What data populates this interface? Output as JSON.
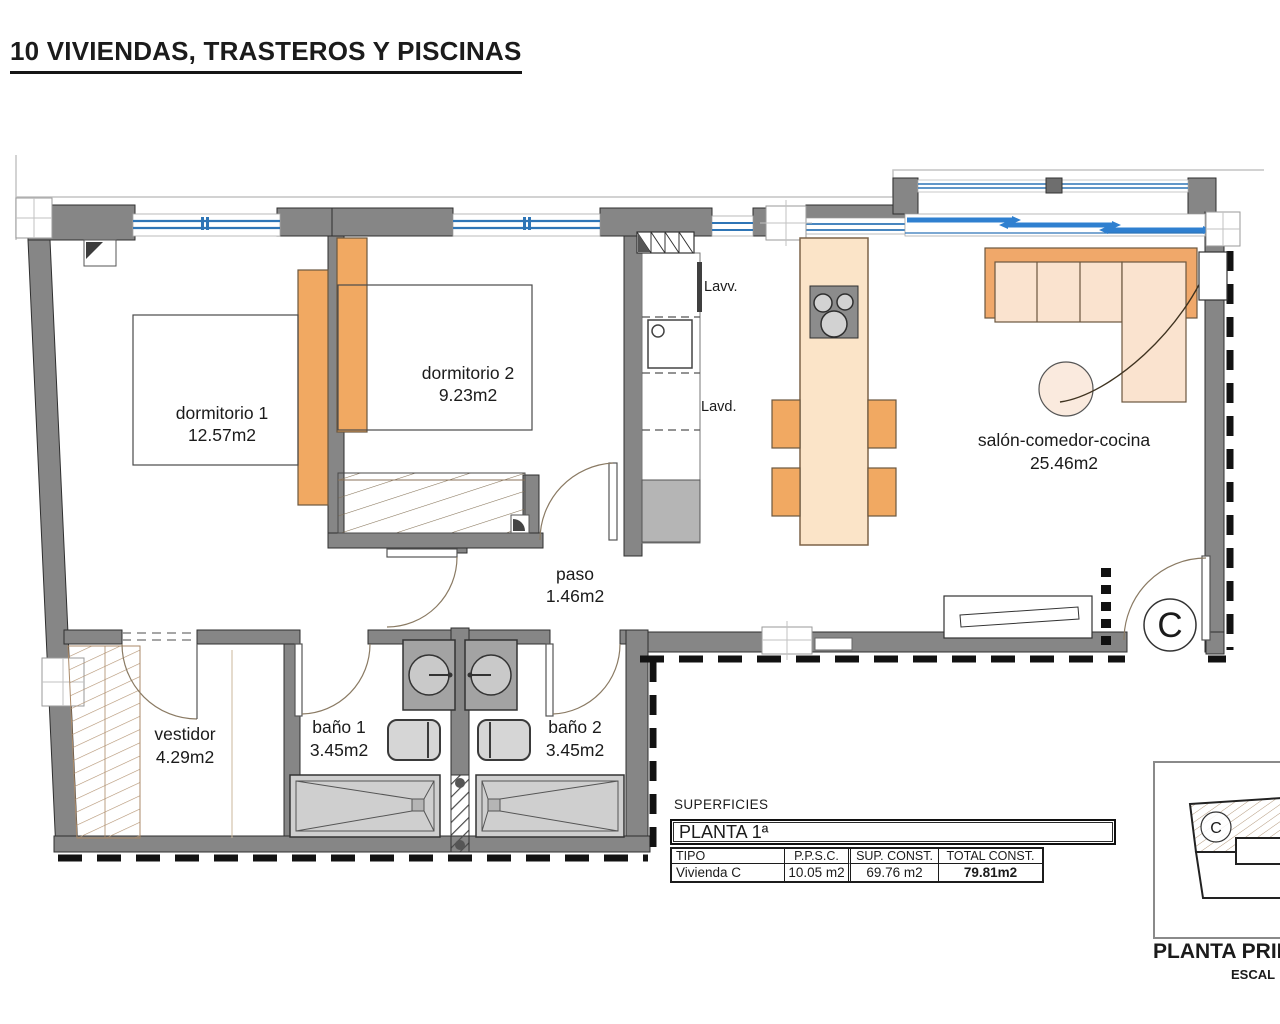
{
  "title": "10 VIVIENDAS, TRASTEROS Y PISCINAS",
  "rooms": {
    "dormitorio1": {
      "name": "dormitorio 1",
      "area": "12.57m2"
    },
    "dormitorio2": {
      "name": "dormitorio 2",
      "area": "9.23m2"
    },
    "paso": {
      "name": "paso",
      "area": "1.46m2"
    },
    "salon": {
      "name": "salón-comedor-cocina",
      "area": "25.46m2"
    },
    "vestidor": {
      "name": "vestidor",
      "area": "4.29m2"
    },
    "bano1": {
      "name": "baño 1",
      "area": "3.45m2"
    },
    "bano2": {
      "name": "baño 2",
      "area": "3.45m2"
    }
  },
  "fixtures": {
    "lavv": "Lavv.",
    "lavd": "Lavd."
  },
  "unit_marker": "C",
  "surfaces": {
    "heading": "SUPERFICIES",
    "floor_label": "PLANTA 1ª",
    "columns": [
      "TIPO",
      "P.P.S.C.",
      "SUP. CONST.",
      "TOTAL CONST."
    ],
    "row": {
      "tipo": "Vivienda C",
      "ppsc": "10.05 m2",
      "sup_const": "69.76 m2",
      "total_const": "79.81m2"
    }
  },
  "key_plan": {
    "unit_marker": "C",
    "caption": "PLANTA PRIM",
    "scale_label": "ESCAL"
  },
  "colors": {
    "wall": "#868686",
    "window_blue": "#2e75b6",
    "sliding_blue": "#2f80d0",
    "furniture_orange": "#f1a962",
    "furniture_peach": "#fae3cf",
    "hatch_tan": "#ab8a68"
  }
}
